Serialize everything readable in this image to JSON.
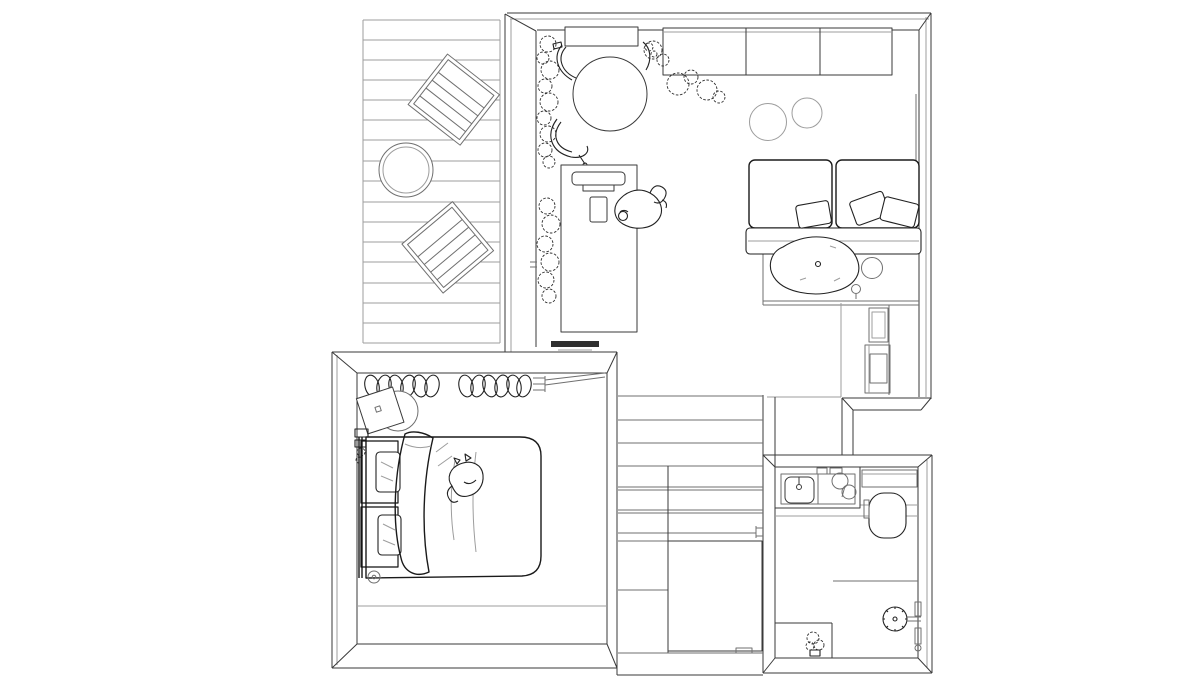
{
  "plan": {
    "title": "Small apartment floor plan — top-view black and white line drawing",
    "background": "#ffffff",
    "ink": {
      "structure": "#3a3a3a",
      "light": "#9d9d9d",
      "medium": "#6f6f6f",
      "sketch": "#1a1a1a",
      "tv_fill": "#2f2f2f"
    },
    "rooms": [
      {
        "name": "terrace-deck",
        "items": [
          "wood-plank-decking",
          "lounge-chair",
          "lounge-chair",
          "round-outdoor-table"
        ]
      },
      {
        "name": "living-dining-kitchen",
        "items": [
          "kitchen-counter",
          "upper-cabinet-block",
          "round-dining-table",
          "dining-chair",
          "dining-chair",
          "dining-chair",
          "potted-plants-row",
          "monstera-plants",
          "work-desk",
          "desk-monitor",
          "desk-tablet",
          "desk-chair",
          "cat-on-desk-chair",
          "wall-mounted-tv",
          "sofa-cushions",
          "throw-pillows",
          "sofa-seat",
          "organic-coffee-table",
          "round-side-table",
          "small-lamp",
          "floor-pouf",
          "floor-pouf",
          "storage-cabinet",
          "floor-platform"
        ]
      },
      {
        "name": "bedroom",
        "items": [
          "double-bed",
          "textured-pillows",
          "duvet",
          "sleeping-cat",
          "clothes-rail-with-hangers",
          "rail-wall-bracket",
          "bedside-table",
          "floor-knob",
          "small-storage-items"
        ]
      },
      {
        "name": "hall-closet",
        "items": [
          "stair-treads",
          "closet-shelves",
          "clothes-rail",
          "sliding-door-panel",
          "door-handle"
        ]
      },
      {
        "name": "bathroom",
        "items": [
          "vanity-counter",
          "basin-sink",
          "faucet",
          "vessel-bowls",
          "mirror-shelf",
          "toilet",
          "shower-partition",
          "shower-head",
          "shower-wall-fixture",
          "potted-plant",
          "corner-bench"
        ]
      }
    ]
  }
}
